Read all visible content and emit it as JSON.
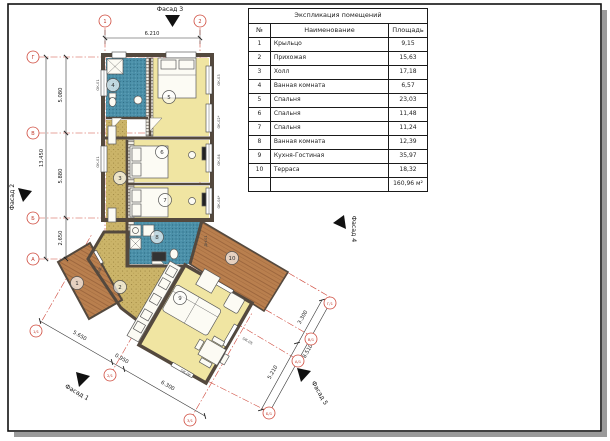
{
  "table": {
    "title": "Экспликация помещений",
    "columns": [
      "№",
      "Наименование",
      "Площадь"
    ],
    "rows": [
      [
        "1",
        "Крыльцо",
        "9,15"
      ],
      [
        "2",
        "Прихожая",
        "15,63"
      ],
      [
        "3",
        "Холл",
        "17,18"
      ],
      [
        "4",
        "Ванная комната",
        "6,57"
      ],
      [
        "5",
        "Спальня",
        "23,03"
      ],
      [
        "6",
        "Спальня",
        "11,48"
      ],
      [
        "7",
        "Спальня",
        "11,24"
      ],
      [
        "8",
        "Ванная комната",
        "12,39"
      ],
      [
        "9",
        "Кухня-Гостиная",
        "35,97"
      ],
      [
        "10",
        "Терраса",
        "18,32"
      ]
    ],
    "total": "160,96 м²"
  },
  "rooms": [
    {
      "number": "1",
      "name": "Крыльцо"
    },
    {
      "number": "2",
      "name": "Прихожая"
    },
    {
      "number": "3",
      "name": "Холл"
    },
    {
      "number": "4",
      "name": "Ванная комната"
    },
    {
      "number": "5",
      "name": "Спальня"
    },
    {
      "number": "6",
      "name": "Спальня"
    },
    {
      "number": "7",
      "name": "Спальня"
    },
    {
      "number": "8",
      "name": "Ванная комната"
    },
    {
      "number": "9",
      "name": "Кухня-Гостиная"
    },
    {
      "number": "10",
      "name": "Терраса"
    }
  ],
  "grid": {
    "top": [
      "1",
      "2"
    ],
    "left": [
      "Г",
      "В",
      "Б",
      "А"
    ],
    "bottom": [
      "1/1",
      "2/1",
      "3/1"
    ],
    "right": [
      "Г/1",
      "В/1",
      "А/1",
      "Б/1"
    ]
  },
  "dims": {
    "top": "6.210",
    "left_total": "13.450",
    "left_segments": [
      "5.080",
      "5.880",
      "2.650"
    ],
    "bottom_segments": [
      "5.650",
      "0.950",
      "6.300"
    ],
    "right_segments": [
      "3.300",
      "5.210"
    ],
    "right_total": "8.510"
  },
  "facades": {
    "f1": "Фасад 1",
    "f2": "Фасад 2",
    "f3": "Фасад 3",
    "f4": "Фасад 4",
    "f5": "Фасад 5"
  },
  "tags": [
    "ОК-01",
    "ОК-01",
    "ОК-03",
    "ОК-02*",
    "ОК-04",
    "ОК-04*",
    "ДН-01",
    "ОК-05",
    "ОК-06",
    "ДВ-01"
  ],
  "colors": {
    "room_yellow": "#f0e5a2",
    "room_blue": "#4b90a9",
    "room_khaki": "#cbb469",
    "wood_brown": "#b97f4e",
    "wall": "#54493e",
    "grid_red": "#cf4a3d",
    "dim_line": "#333333"
  }
}
